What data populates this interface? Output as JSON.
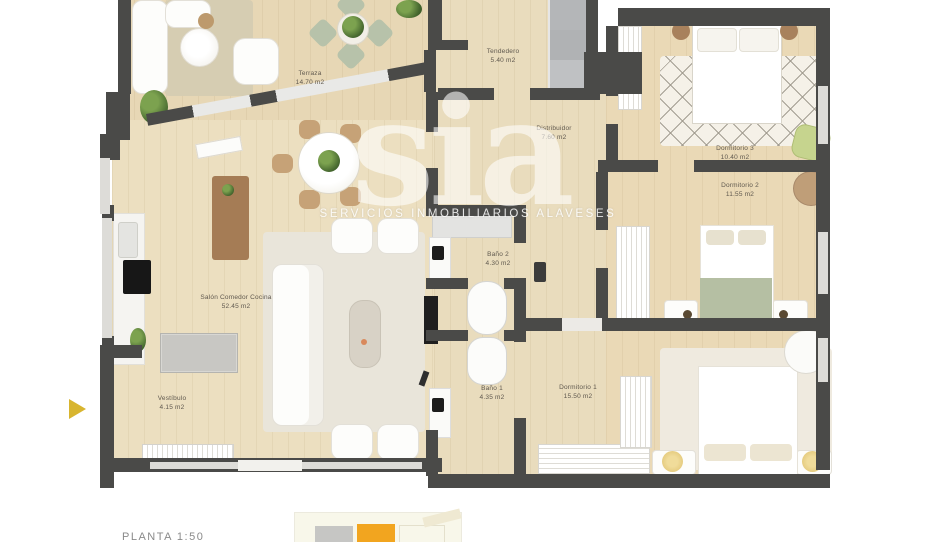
{
  "watermark": {
    "logo": "sia",
    "tagline": "SERVICIOS INMOBILIARIOS ALAVESES"
  },
  "carousel": {
    "arrow_color": "#d8b52f"
  },
  "floorplan": {
    "rooms": [
      {
        "name": "Terraza",
        "area": "14.70 m2"
      },
      {
        "name": "Salón Comedor Cocina",
        "area": "52.45 m2"
      },
      {
        "name": "Vestíbulo",
        "area": "4.15 m2"
      },
      {
        "name": "Tendedero",
        "area": "5.40 m2"
      },
      {
        "name": "Distribuidor",
        "area": "7.60 m2"
      },
      {
        "name": "Baño 2",
        "area": "4.30 m2"
      },
      {
        "name": "Baño 1",
        "area": "4.35 m2"
      },
      {
        "name": "Dormitorio 1",
        "area": "15.50 m2"
      },
      {
        "name": "Dormitorio 2",
        "area": "11.55 m2"
      },
      {
        "name": "Dormitorio 3",
        "area": "10.40 m2"
      }
    ],
    "colors": {
      "wall": "#4a4a48",
      "floor_wood": "#e9dcbd",
      "sage": "#b5bfa3",
      "lamp_gold": "#ddbf6b"
    }
  },
  "next_image": {
    "caption": "PLANTA 1:50",
    "highlight_orange": "#f2a51f",
    "highlight_grey": "#c6c6c4"
  }
}
